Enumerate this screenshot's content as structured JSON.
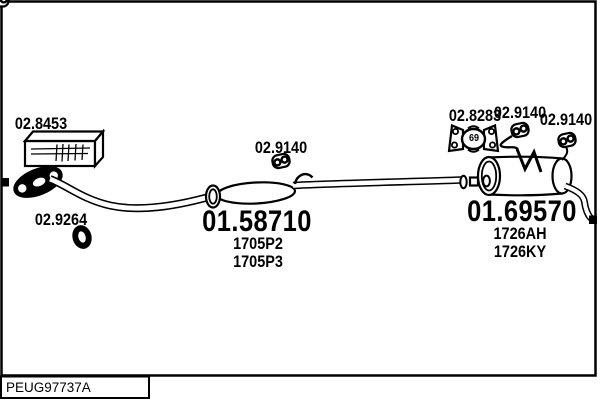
{
  "parts": {
    "mount_kit": "02.8453",
    "front_gasket": "02.9264",
    "mid_hanger": "02.9140",
    "rear_bracket": "02.8283",
    "rear_bracket_marking": "69",
    "rear_hanger_1": "02.9140",
    "rear_hanger_2": "02.9140",
    "centre_silencer": {
      "number": "01.58710",
      "oe_refs": [
        "1705P2",
        "1705P3"
      ]
    },
    "rear_silencer": {
      "number": "01.69570",
      "oe_refs": [
        "1726AH",
        "1726KY"
      ]
    }
  },
  "footer": {
    "drawing_code": "PEUG97737A"
  },
  "colors": {
    "line": "#000000",
    "background": "#ffffff"
  }
}
